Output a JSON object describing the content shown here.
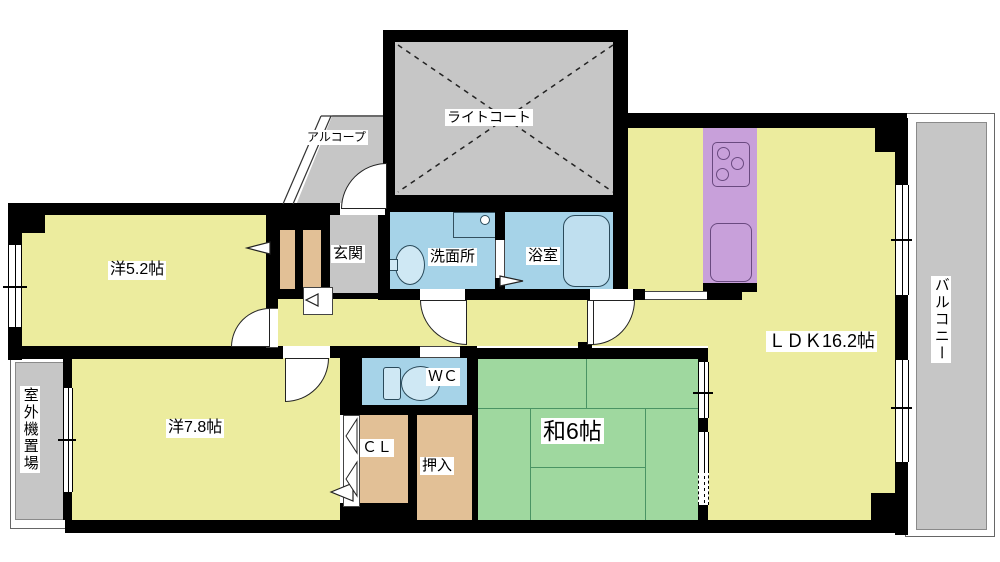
{
  "floor_plan": {
    "type": "japanese-apartment-floor-plan",
    "rooms": {
      "light_court": {
        "label": "ライトコート"
      },
      "alcove": {
        "label": "アルコープ"
      },
      "western_room_5_2": {
        "label": "洋5.2帖"
      },
      "entrance": {
        "label": "玄関"
      },
      "washroom": {
        "label": "洗面所"
      },
      "bathroom": {
        "label": "浴室"
      },
      "ldk": {
        "label": "ＬＤＫ16.2帖"
      },
      "balcony": {
        "label": "バルコニー"
      },
      "outdoor_unit_storage": {
        "label": "室外機置場"
      },
      "western_room_7_8": {
        "label": "洋7.8帖"
      },
      "toilet_room": {
        "label": "ＷＣ"
      },
      "closet": {
        "label": "ＣＬ"
      },
      "oshiire": {
        "label": "押入"
      },
      "japanese_room_6": {
        "label": "和6帖"
      }
    },
    "colors": {
      "wall": "#000000",
      "room_yellow": "#ecec9e",
      "tatami_green": "#9fd89f",
      "water_blue": "#a6d3e8",
      "fixture_blue": "#cfe8f4",
      "storage_tan": "#e2c096",
      "kitchen_purple": "#c8a0da",
      "common_gray": "#c6c6c6"
    }
  }
}
